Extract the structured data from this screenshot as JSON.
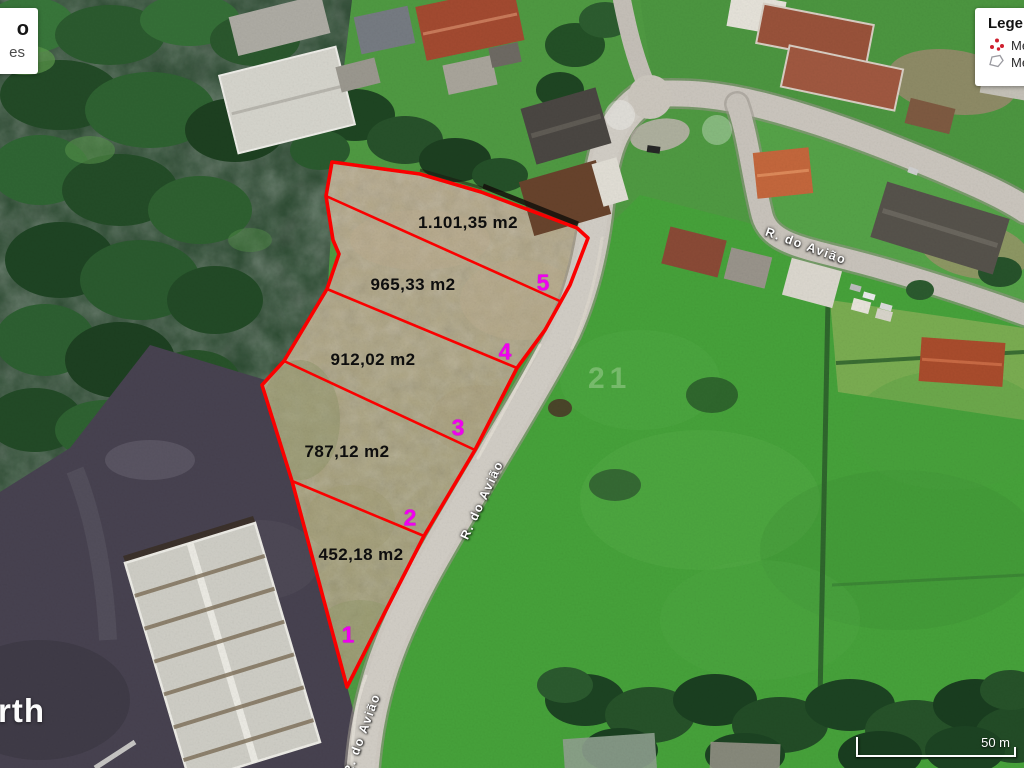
{
  "info_box": {
    "title_fragment": "o",
    "subtitle_fragment": "es"
  },
  "legend": {
    "title": "Legenda",
    "items": [
      {
        "icon": "measure-points-icon",
        "label": "Me"
      },
      {
        "icon": "measure-polygon-icon",
        "label": "Me"
      }
    ]
  },
  "scale_bar": {
    "label": "50 m"
  },
  "watermark": {
    "fragment": "rth",
    "faint_text": "21"
  },
  "map": {
    "street_name": "R. do Avião",
    "street_labels": [
      {
        "text": "R. do Avião"
      },
      {
        "text": "R. do Avião"
      },
      {
        "text": "R. do Avião"
      }
    ],
    "parcels": [
      {
        "number": "1",
        "area": "452,18 m2"
      },
      {
        "number": "2",
        "area": "787,12 m2"
      },
      {
        "number": "3",
        "area": "912,02 m2"
      },
      {
        "number": "4",
        "area": "965,33 m2"
      },
      {
        "number": "5",
        "area": "1.101,35 m2"
      }
    ],
    "colors": {
      "boundary": "#ff0000",
      "vertex_label": "#f000f0",
      "area_label": "#0e0e0e",
      "road": "#cfcac2",
      "field_green": "#46a23a",
      "forest_green": "#24452a",
      "terrain_tan": "#b0a484",
      "dark_yard": "#474250"
    }
  }
}
